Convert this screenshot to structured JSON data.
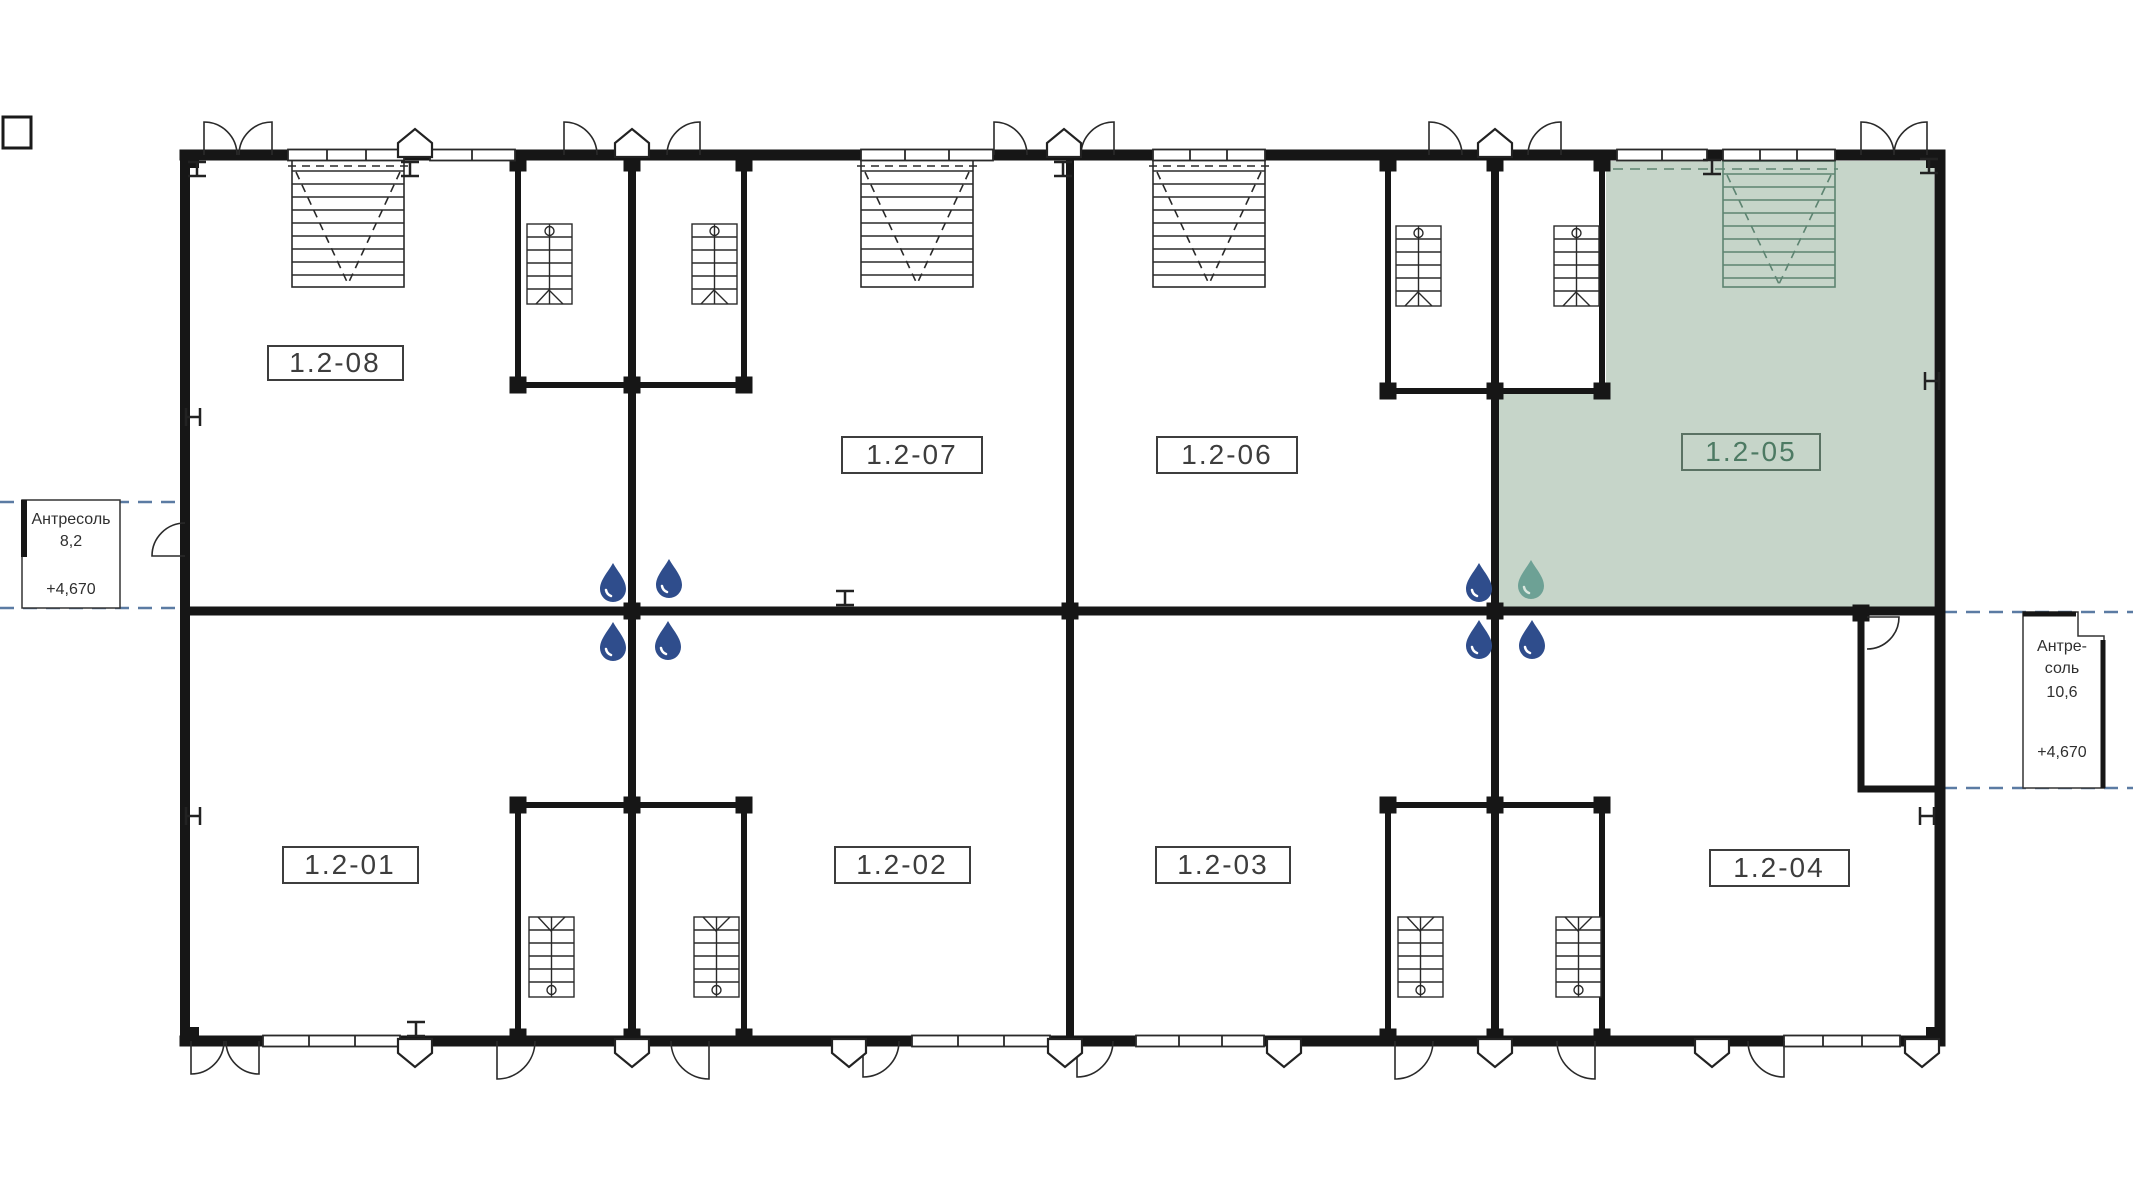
{
  "page": {
    "width": 2133,
    "height": 1200,
    "background": "#ffffff"
  },
  "plan": {
    "units": {
      "top_row": [
        {
          "id": "1.2-08",
          "highlighted": false
        },
        {
          "id": "1.2-07",
          "highlighted": false
        },
        {
          "id": "1.2-06",
          "highlighted": false
        },
        {
          "id": "1.2-05",
          "highlighted": true
        }
      ],
      "bottom_row": [
        {
          "id": "1.2-01",
          "highlighted": false
        },
        {
          "id": "1.2-02",
          "highlighted": false
        },
        {
          "id": "1.2-03",
          "highlighted": false
        },
        {
          "id": "1.2-04",
          "highlighted": false
        }
      ]
    },
    "selected_unit": "1.2-05",
    "mezzanine_left": {
      "title": "Антресоль",
      "area": "8,2",
      "elevation": "+4,670"
    },
    "mezzanine_right": {
      "title_line1": "Антре-",
      "title_line2": "соль",
      "area": "10,6",
      "elevation": "+4,670"
    }
  },
  "icons": {
    "water_drop": "water-drop-icon",
    "water_drop_selected": "water-drop-selected-icon",
    "entrance_arrow": "entrance-arrow-icon",
    "column_marker": "column-marker-icon"
  },
  "colors": {
    "wall": "#161616",
    "line": "#2a2a2a",
    "highlight_fill": "#c6d5c9",
    "highlight_line": "#5d8471",
    "highlight_label_text": "#4d7a63",
    "label_text": "#3d3d3d",
    "mezzanine_dashed_line": "#5b7ba3",
    "water_drop_blue": "#2f4d8c",
    "water_drop_teal": "#6da195"
  }
}
